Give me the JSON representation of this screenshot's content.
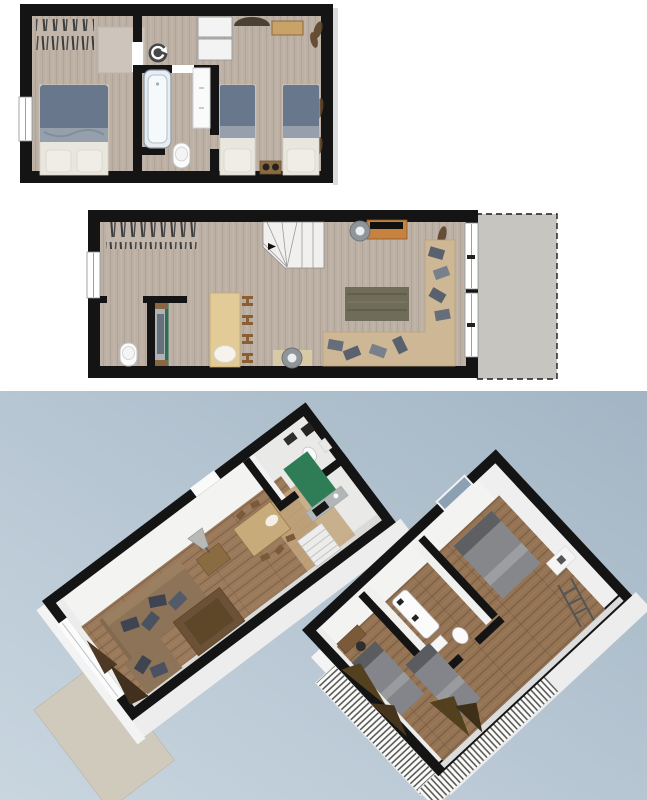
{
  "palette": {
    "page_bg": "#ffffff",
    "wall": "#141414",
    "plan_floor": "#bcb0a5",
    "plan_floor_streak": "#b0a499",
    "rug_stripe": "#3c3c3c",
    "rug_light": "#cdc5bb",
    "duvet_blue": "#68778c",
    "duvet_fold": "#96a0ac",
    "bed_linen": "#e9e6de",
    "pillow": "#efede6",
    "tub_fill": "#e8edf2",
    "tub_stroke": "#8d9aa5",
    "fixture_white": "#fcfcfc",
    "closet_white": "#f3f3f4",
    "desk_wood": "#c9a267",
    "nightstand_wood": "#8a6b42",
    "plant_brown": "#5c432a",
    "stairs_fill": "#f1f0ee",
    "sideboard_orange": "#c8823f",
    "tv_black": "#101010",
    "lamp_gray": "#90959a",
    "rug_dark": "#6f6c59",
    "sofa_beige": "#cdb795",
    "cushion_gray": "#59616e",
    "bar_table": "#e2cb97",
    "stool_wood": "#8a5f33",
    "kitchen_counter": "#b0b3b3",
    "kitchen_green": "#2d6e54",
    "terrace_gray": "#c7c5c0",
    "sky_top": "#a3b5c4",
    "sky_bottom": "#c9d6e0",
    "wood3d": "#9b7a5c",
    "wood3d_dark": "#82644a",
    "slab_white": "#ededed",
    "wallface_white": "#f3f3f1",
    "kitchen3d_green": "#2f7d57",
    "couch_brown": "#8d7358",
    "couch_back": "#9a8060",
    "cushion_dark": "#3e4450",
    "ottoman_brown": "#6b5236",
    "terrace3d": "#cfcabc",
    "bed3d_gray": "#85878b",
    "bed3d_pillow": "#5d5f63",
    "railing_white": "#fcfcfc",
    "glass_blue": "#8ba0b2",
    "rotate_icon": "#474747"
  },
  "views": [
    {
      "id": "upper-floor-plan",
      "type": "2d-floor-plan",
      "elements": [
        "striped-rug",
        "area-rug",
        "double-bed",
        "window",
        "door-opening",
        "rotate-marker",
        "wardrobe-units",
        "desk",
        "desk-chair",
        "plants",
        "bathtub",
        "toilet",
        "bathroom-closet",
        "single-bed-left",
        "single-bed-right",
        "nightstand"
      ]
    },
    {
      "id": "ground-floor-plan",
      "type": "2d-floor-plan",
      "elements": [
        "striped-rug",
        "window",
        "winder-staircase",
        "direction-arrow",
        "tv-sideboard",
        "tv",
        "floor-lamp-top",
        "floor-lamp-bottom",
        "plants",
        "dark-area-rug",
        "corner-sofa",
        "sofa-cushions",
        "bar-table",
        "bar-stools",
        "white-oval-decor",
        "wc-toilet",
        "kitchen-unit",
        "sliding-windows",
        "terrace-dashed"
      ]
    },
    {
      "id": "ground-floor-3d",
      "type": "3d-view",
      "elements": [
        "terrace-slab",
        "wall-band",
        "wood-floor",
        "sliding-door",
        "green-kitchen-unit",
        "counter-cooktop",
        "wc-fixtures",
        "staircase",
        "bar-table",
        "bar-stools",
        "white-oval-decor",
        "side-table",
        "cone-lamp",
        "couch",
        "chaise",
        "ottoman",
        "dark-cushions",
        "plant"
      ]
    },
    {
      "id": "upper-floor-3d",
      "type": "3d-view",
      "elements": [
        "wall-band",
        "wood-floor",
        "roof-window",
        "double-bed",
        "wardrobe",
        "bathtub",
        "washbasin",
        "toilet",
        "twin-bed-1",
        "twin-bed-2",
        "desk",
        "desk-chair",
        "plants",
        "stair-ladder",
        "balustrade-railing"
      ]
    }
  ]
}
